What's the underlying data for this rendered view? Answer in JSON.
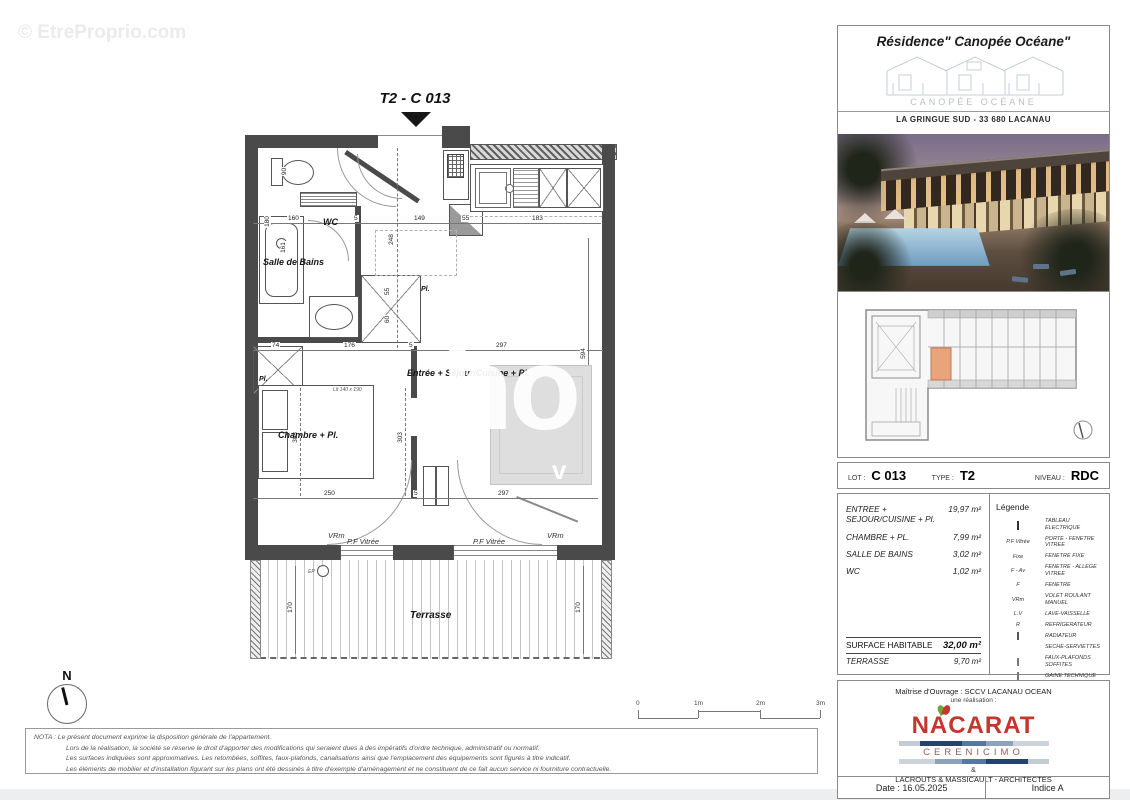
{
  "colors": {
    "wall": "#4a4a4a",
    "unit_highlight": "#e9a47c",
    "nacarat_red": "#c0392c"
  },
  "watermarks": {
    "top_left": "© EtreProprio.com",
    "center_line1": "IS",
    "center_line2": "ho",
    "center_line3": "v"
  },
  "plan": {
    "title": "T2 - C 013",
    "rooms": {
      "wc": "WC",
      "bath": "Salle de Bains",
      "bedroom": "Chambre + Pl.",
      "living": "Entrée + Séjour/Cuisine + Pl.",
      "terrace": "Terrasse"
    },
    "windows": {
      "vrm_l": "VRm",
      "pf_l": "P.F Vitrée",
      "pf_r": "P.F Vitrée",
      "vrm_r": "VRm"
    },
    "misc": {
      "ep": "EP",
      "pl_a": "Pl.",
      "pl_b": "Pl.",
      "bed": "Lit 140 x 190"
    },
    "dims": {
      "top": [
        "160",
        "5",
        "149",
        "55",
        "183"
      ],
      "mid": [
        "74",
        "176",
        "5",
        "297"
      ],
      "bottom": [
        "250",
        "5",
        "297"
      ],
      "vert": [
        "248",
        "594",
        "303",
        "303",
        "170",
        "170",
        "161",
        "90",
        "180",
        "55",
        "60"
      ]
    }
  },
  "scalebar": {
    "ticks": [
      "0",
      "1m",
      "2m",
      "3m"
    ]
  },
  "north": {
    "label": "N"
  },
  "nota": {
    "lines": [
      "NOTA : Le présent document exprime la disposition générale de l'appartement.",
      "Lors de la réalisation, la société se réserve le droit d'apporter des modifications qui seraient dues à des impératifs d'ordre technique, administratif ou normatif.",
      "Les surfaces indiquées sont approximatives. Les retombées, soffites, faux-plafonds, canalisations ainsi que l'emplacement des équipements sont figurés à titre indicatif.",
      "Les éléments de mobilier et d'installation figurant sur les plans ont été dessinés à titre d'exemple d'aménagement et ne constituent de ce fait aucun service ni fourniture contractuelle."
    ]
  },
  "sidebar": {
    "header": {
      "title": "Résidence\" Canopée Océane\"",
      "logo_caption": "CANOPÉE OCÉANE",
      "address": "LA GRINGUE SUD - 33 680 LACANAU"
    },
    "lot": {
      "lot_label": "LOT :",
      "lot_value": "C 013",
      "type_label": "TYPE :",
      "type_value": "T2",
      "level_label": "NIVEAU :",
      "level_value": "RDC"
    },
    "areas": {
      "rows": [
        {
          "label": "ENTREE + SEJOUR/CUISINE + Pl.",
          "value": "19,97 m²"
        },
        {
          "label": "CHAMBRE + PL.",
          "value": "7,99 m²"
        },
        {
          "label": "SALLE DE BAINS",
          "value": "3,02 m²"
        },
        {
          "label": "WC",
          "value": "1,02 m²"
        }
      ],
      "hab_label": "SURFACE HABITABLE",
      "hab_value": "32,00 m²",
      "ter_label": "TERRASSE",
      "ter_value": "9,70 m²"
    },
    "legend": {
      "title": "Légende",
      "items": [
        {
          "key": "",
          "desc": "TABLEAU ELECTRIQUE"
        },
        {
          "key": "P.F Vitrée",
          "desc": "PORTE - FENETRE VITREE"
        },
        {
          "key": "Fixe",
          "desc": "FENETRE FIXE"
        },
        {
          "key": "F - Av",
          "desc": "FENETRE - ALLEGE VITREE"
        },
        {
          "key": "F",
          "desc": "FENETRE"
        },
        {
          "key": "VRm",
          "desc": "VOLET ROULANT MANUEL"
        },
        {
          "key": "L.V",
          "desc": "LAVE-VAISSELLE"
        },
        {
          "key": "R",
          "desc": "REFRIGERATEUR"
        },
        {
          "key": "",
          "desc": "RADIATEUR"
        },
        {
          "key": "",
          "desc": "SECHE-SERVIETTES"
        },
        {
          "key": "",
          "desc": "FAUX-PLAFONDS SOFFITES"
        },
        {
          "key": "",
          "desc": "GAINE TECHNIQUE"
        }
      ]
    },
    "realization": {
      "owner": "Maîtrise d'Ouvrage : SCCV LACANAU OCEAN",
      "sub": "une réalisation :",
      "brand1": "NACARAT",
      "brand2": "CERENICIMO",
      "amp": "&",
      "architects": "LACROUTS & MASSICAULT - ARCHITECTES"
    },
    "footer": {
      "date": "Date : 16.05.2025",
      "indice": "Indice A"
    }
  }
}
